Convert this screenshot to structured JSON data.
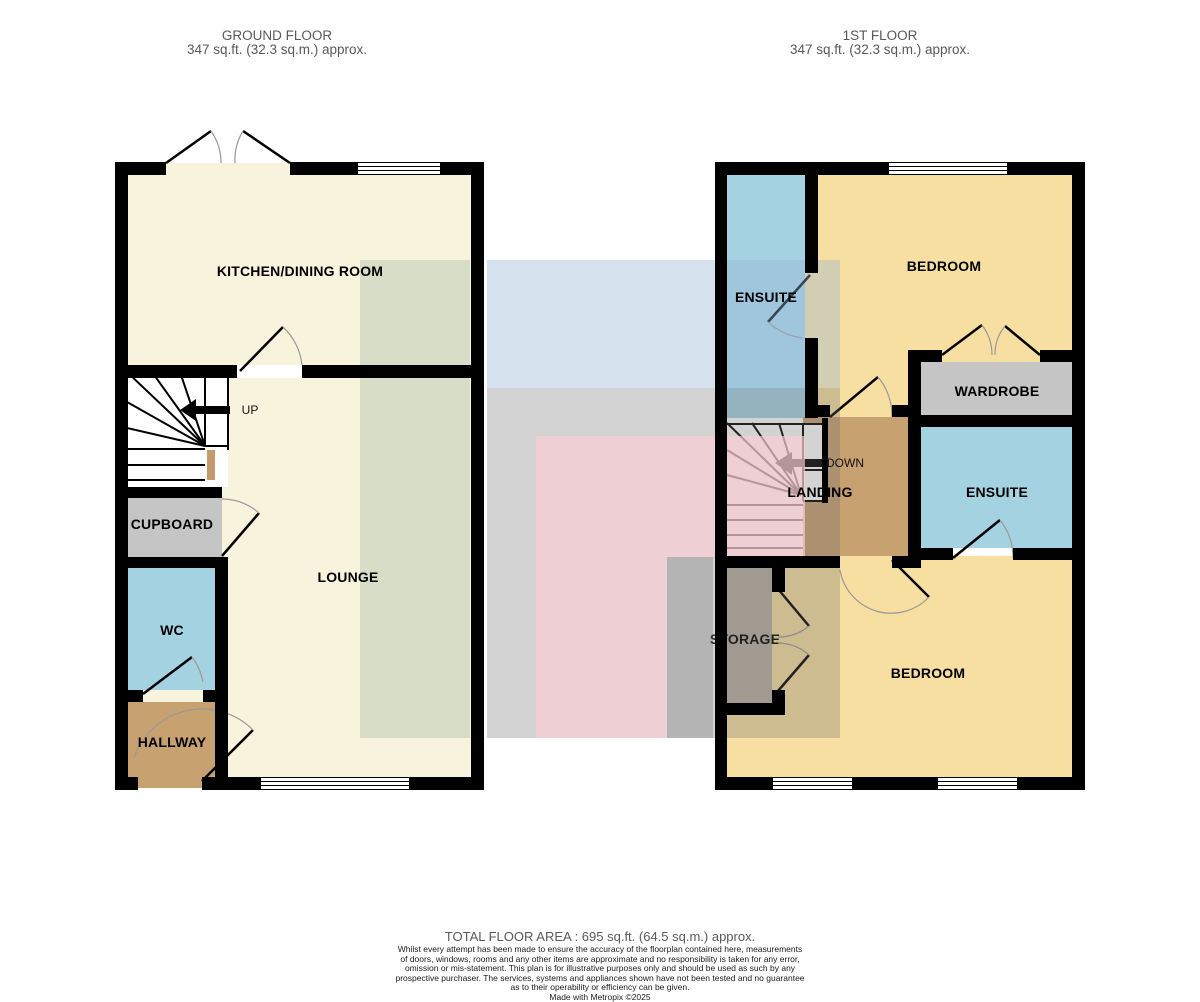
{
  "header": {
    "ground": {
      "title": "GROUND FLOOR",
      "area": "347 sq.ft. (32.3 sq.m.) approx."
    },
    "first": {
      "title": "1ST FLOOR",
      "area": "347 sq.ft. (32.3 sq.m.) approx."
    }
  },
  "rooms": {
    "ground": {
      "kitchen": "KITCHEN/DINING ROOM",
      "lounge": "LOUNGE",
      "cupboard": "CUPBOARD",
      "wc": "WC",
      "hallway": "HALLWAY"
    },
    "first": {
      "ensuite_front": "ENSUITE",
      "bedroom_front": "BEDROOM",
      "wardrobe": "WARDROBE",
      "ensuite_rear": "ENSUITE",
      "landing": "LANDING",
      "storage": "STORAGE",
      "bedroom_rear": "BEDROOM"
    }
  },
  "stairs": {
    "ground_direction": "UP",
    "first_direction": "DOWN"
  },
  "footer": {
    "total_area": "TOTAL FLOOR AREA : 695 sq.ft. (64.5 sq.m.) approx.",
    "disclaimer_lines": [
      "Whilst every attempt has been made to ensure the accuracy of the floorplan contained here, measurements",
      "of doors, windows, rooms and any other items are approximate and no responsibility is taken for any error,",
      "omission or mis-statement. This plan is for illustrative purposes only and should be used as such by any",
      "prospective purchaser. The services, systems and appliances shown have not been tested and no guarantee",
      "as to their operability or efficiency can be given."
    ],
    "credit": "Made with Metropix ©2025"
  },
  "colors": {
    "wall": "#000000",
    "cream": "#F8F3DC",
    "gold": "#F6DFA0",
    "blue_room": "#A5D2E1",
    "gray_room": "#C5C5C5",
    "tan_room": "#C8A171",
    "storage_room": "#B7AE9F",
    "stair_newel": "#C49A6C",
    "door_arc": "#999999",
    "label_text": "#000000",
    "muted_text": "#595959",
    "wm_green": "rgba(150,175,160,0.32)",
    "wm_blue": "rgba(149,178,212,0.38)",
    "wm_gray": "rgba(108,108,108,0.30)",
    "wm_pink": "rgba(250,205,212,0.68)",
    "wm_gray2": "rgba(100,100,100,0.28)"
  }
}
